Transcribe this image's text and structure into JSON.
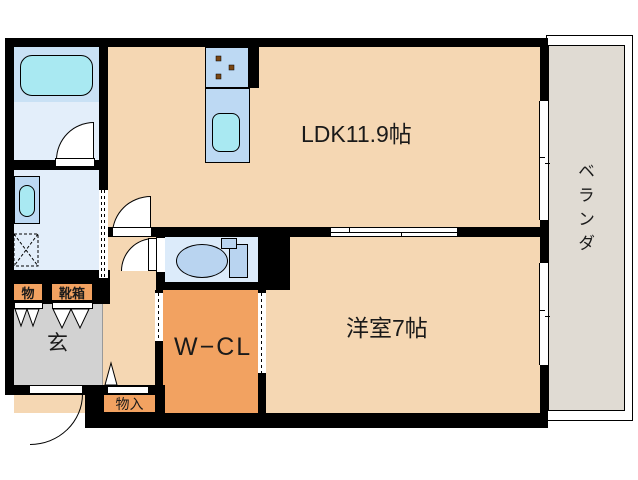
{
  "floorplan": {
    "type": "japanese-apartment-floor-plan",
    "rooms": {
      "ldk": {
        "label": "LDK11.9帖"
      },
      "western_room": {
        "label": "洋室7帖"
      },
      "veranda": {
        "label": "ベランダ"
      },
      "walk_in_closet": {
        "label": "W−CL"
      },
      "entrance": {
        "label": "玄"
      },
      "entrance_storage": {
        "label": "物"
      },
      "shoe_box": {
        "label": "靴箱"
      },
      "hall_storage": {
        "label": "物入"
      }
    },
    "fixtures": [
      "bathtub",
      "bathroom",
      "washbasin-vanity",
      "washing-machine-space",
      "kitchen-stove",
      "kitchen-sink",
      "toilet",
      "sliding-doors",
      "hinged-doors",
      "windows"
    ],
    "colors": {
      "wall": "#000000",
      "room_floor": "#f5d7b3",
      "closet_floor": "#f2a261",
      "entrance_floor": "#d2d2d2",
      "veranda_floor": "#e0dbd3",
      "water_unit_blue": "#bdd9f3",
      "bath_blue": "#c9e1f5",
      "sanitary_blue": "#e3eefa",
      "basin_cyan": "#a9e9f2",
      "burner_brown": "#7a4612"
    }
  }
}
